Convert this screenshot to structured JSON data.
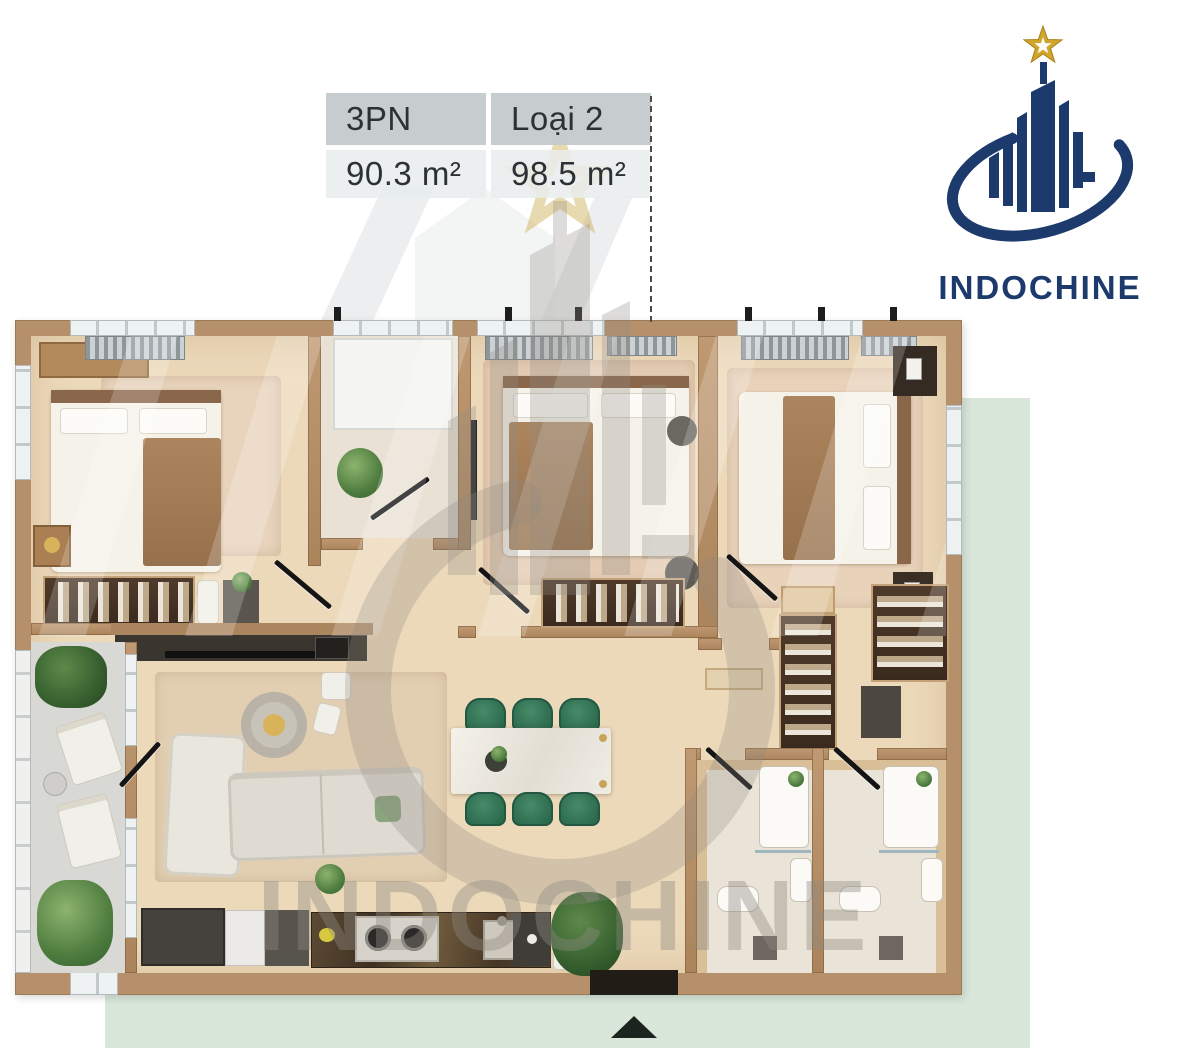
{
  "header": {
    "spec_table": {
      "columns": [
        {
          "header": "3PN",
          "area": "90.3 m²"
        },
        {
          "header": "Loại 2",
          "area": "98.5 m²"
        }
      ]
    },
    "logo": {
      "brand": "INDOCHINE"
    }
  },
  "floor_plan": {
    "watermark_text": "INDOCHINE",
    "entrance_marker": "triangle-up"
  },
  "colors": {
    "backdrop_green": "#d9e7db",
    "wall_tan": "#b6906a",
    "floor_beige": "#ecd9ba",
    "table_header_bg": "#c7cccc",
    "table_cell_bg": "#e9eded",
    "text_dark": "#2c3134",
    "logo_navy": "#1d3a6c",
    "logo_gold": "#d0a62c",
    "dining_chair_green": "#35775a",
    "marker_dark": "#1b241e",
    "watermark_gray": "#8f8a82"
  }
}
